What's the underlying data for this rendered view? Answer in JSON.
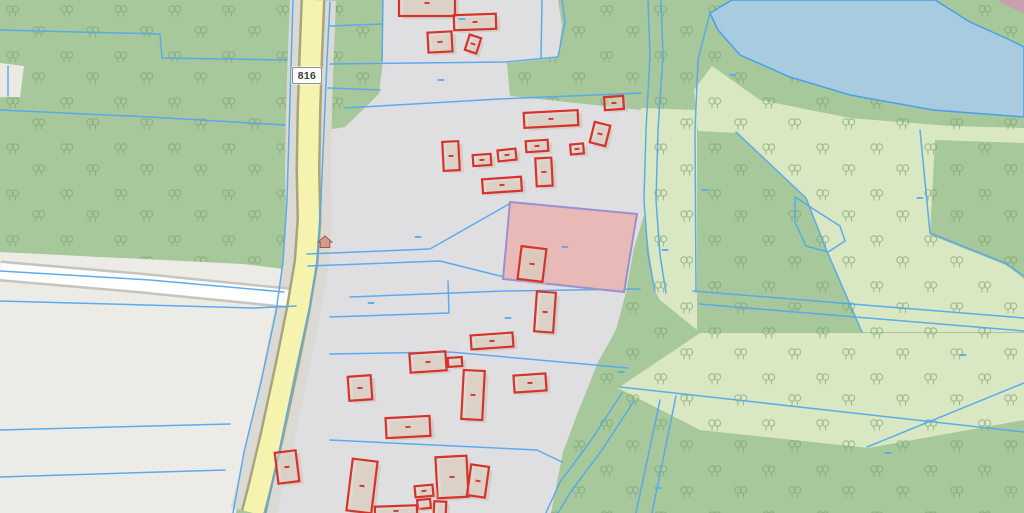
{
  "map": {
    "type": "cadastral-gis-map",
    "road_shield": {
      "label": "816"
    },
    "colors": {
      "forest": "#a7c89a",
      "pale_green": "#d9e8c3",
      "gray_parcels": "#dfdfe1",
      "beige_parcels": "#edebe5",
      "notch": "#eceae4",
      "water": "#a8cbe0",
      "water_edge": "#4aa0e8",
      "parcel_line": "#55a8ee",
      "road_fill": "#f5f3ae",
      "road_casing": "#a8a57c",
      "road_verge": "#dbd9d3",
      "white_road_fill": "#ffffff",
      "white_road_casing": "#c6c4be",
      "building_stroke": "#d5332b",
      "building_fill": "#e0d3c7",
      "building_shadow": "#cabfb2",
      "highlight_fill": "#eab5b3",
      "highlight_stroke": "#9a8fd0",
      "tree": "#7fa271",
      "corner_road": "#c79fae",
      "house_icon_fill": "#cf8a80",
      "house_icon_stroke": "#a9544b"
    },
    "regions": {
      "base": [
        [
          0,
          0
        ],
        [
          1024,
          0
        ],
        [
          1024,
          513
        ],
        [
          0,
          513
        ]
      ],
      "pale_green": [
        [
          [
            712,
            66
          ],
          [
            760,
            100
          ],
          [
            850,
            118
          ],
          [
            950,
            126
          ],
          [
            1024,
            128
          ],
          [
            1024,
            143
          ],
          [
            935,
            140
          ],
          [
            930,
            235
          ],
          [
            1008,
            266
          ],
          [
            1024,
            279
          ],
          [
            1024,
            332
          ],
          [
            862,
            332
          ],
          [
            826,
            249
          ],
          [
            806,
            198
          ],
          [
            737,
            133
          ],
          [
            698,
            131
          ],
          [
            694,
            90
          ]
        ],
        [
          [
            641,
            108
          ],
          [
            697,
            110
          ],
          [
            697,
            330
          ],
          [
            660,
            300
          ],
          [
            655,
            291
          ],
          [
            644,
            215
          ]
        ],
        [
          [
            618,
            388
          ],
          [
            700,
            333
          ],
          [
            1024,
            333
          ],
          [
            1024,
            420
          ],
          [
            868,
            448
          ],
          [
            700,
            430
          ]
        ]
      ],
      "notch": [
        [
          0,
          63
        ],
        [
          24,
          66
        ],
        [
          20,
          97
        ],
        [
          0,
          97
        ]
      ],
      "water": [
        [
          732,
          0
        ],
        [
          935,
          0
        ],
        [
          970,
          22
        ],
        [
          1010,
          40
        ],
        [
          1024,
          47
        ],
        [
          1024,
          117
        ],
        [
          933,
          110
        ],
        [
          850,
          95
        ],
        [
          790,
          77
        ],
        [
          740,
          55
        ],
        [
          718,
          30
        ],
        [
          710,
          13
        ]
      ],
      "corner_road": [
        [
          998,
          0
        ],
        [
          1024,
          0
        ],
        [
          1024,
          13
        ],
        [
          1005,
          5
        ]
      ],
      "gray_parcels": [
        [
          385,
          0
        ],
        [
          558,
          0
        ],
        [
          562,
          25
        ],
        [
          558,
          58
        ],
        [
          507,
          63
        ],
        [
          510,
          96
        ],
        [
          641,
          110
        ],
        [
          644,
          215
        ],
        [
          634,
          248
        ],
        [
          626,
          292
        ],
        [
          616,
          330
        ],
        [
          598,
          362
        ],
        [
          578,
          412
        ],
        [
          563,
          452
        ],
        [
          551,
          513
        ],
        [
          268,
          513
        ],
        [
          283,
          440
        ],
        [
          299,
          362
        ],
        [
          313,
          302
        ],
        [
          319,
          262
        ],
        [
          323,
          200
        ],
        [
          327,
          130
        ],
        [
          345,
          127
        ],
        [
          379,
          94
        ],
        [
          383,
          60
        ],
        [
          383,
          0
        ]
      ],
      "beige_parcels": [
        [
          0,
          252
        ],
        [
          243,
          264
        ],
        [
          292,
          270
        ],
        [
          286,
          308
        ],
        [
          263,
          380
        ],
        [
          246,
          450
        ],
        [
          236,
          513
        ],
        [
          0,
          513
        ]
      ]
    },
    "tree_areas": [
      [
        [
          0,
          0
        ],
        [
          340,
          0
        ],
        [
          330,
          130
        ],
        [
          324,
          200
        ],
        [
          320,
          262
        ],
        [
          240,
          264
        ],
        [
          0,
          252
        ]
      ],
      [
        [
          333,
          0
        ],
        [
          385,
          0
        ],
        [
          380,
          95
        ],
        [
          345,
          130
        ],
        [
          330,
          133
        ]
      ],
      [
        [
          558,
          0
        ],
        [
          1024,
          0
        ],
        [
          1024,
          513
        ],
        [
          548,
          513
        ],
        [
          575,
          440
        ],
        [
          600,
          360
        ],
        [
          620,
          330
        ],
        [
          628,
          292
        ],
        [
          644,
          248
        ],
        [
          646,
          215
        ],
        [
          643,
          110
        ],
        [
          510,
          96
        ],
        [
          507,
          62
        ],
        [
          560,
          57
        ],
        [
          563,
          25
        ]
      ]
    ],
    "roads": {
      "main": [
        [
          313,
          0
        ],
        [
          311,
          50
        ],
        [
          309,
          110
        ],
        [
          308,
          170
        ],
        [
          309,
          220
        ],
        [
          306,
          262
        ],
        [
          298,
          310
        ],
        [
          287,
          365
        ],
        [
          272,
          435
        ],
        [
          259,
          490
        ],
        [
          253,
          513
        ]
      ],
      "side": [
        [
          0,
          271
        ],
        [
          140,
          283
        ],
        [
          290,
          298
        ]
      ]
    },
    "parcel_lines": [
      [
        [
          0,
          30
        ],
        [
          160,
          34
        ],
        [
          162,
          58
        ],
        [
          287,
          60
        ]
      ],
      [
        [
          0,
          110
        ],
        [
          150,
          117
        ],
        [
          285,
          125
        ]
      ],
      [
        [
          0,
          271
        ],
        [
          150,
          280
        ],
        [
          284,
          292
        ]
      ],
      [
        [
          0,
          301
        ],
        [
          253,
          308
        ],
        [
          296,
          306
        ]
      ],
      [
        [
          330,
          2
        ],
        [
          327,
          60
        ],
        [
          324,
          130
        ],
        [
          321,
          200
        ],
        [
          317,
          262
        ],
        [
          310,
          305
        ],
        [
          297,
          365
        ],
        [
          281,
          442
        ],
        [
          266,
          513
        ]
      ],
      [
        [
          293,
          0
        ],
        [
          290,
          100
        ],
        [
          287,
          200
        ],
        [
          283,
          262
        ],
        [
          276,
          312
        ],
        [
          261,
          382
        ],
        [
          244,
          452
        ],
        [
          233,
          513
        ]
      ],
      [
        [
          383,
          0
        ],
        [
          382,
          61
        ]
      ],
      [
        [
          542,
          0
        ],
        [
          541,
          58
        ]
      ],
      [
        [
          330,
          64
        ],
        [
          505,
          62
        ],
        [
          558,
          57
        ],
        [
          565,
          22
        ],
        [
          562,
          0
        ]
      ],
      [
        [
          345,
          108
        ],
        [
          500,
          99
        ],
        [
          641,
          93
        ]
      ],
      [
        [
          648,
          0
        ],
        [
          650,
          55
        ],
        [
          646,
          130
        ],
        [
          644,
          200
        ],
        [
          648,
          255
        ],
        [
          655,
          291
        ]
      ],
      [
        [
          661,
          0
        ],
        [
          663,
          55
        ],
        [
          658,
          130
        ],
        [
          656,
          200
        ],
        [
          660,
          255
        ],
        [
          666,
          293
        ]
      ],
      [
        [
          307,
          254
        ],
        [
          430,
          249
        ],
        [
          509,
          204
        ]
      ],
      [
        [
          308,
          266
        ],
        [
          440,
          261
        ],
        [
          504,
          277
        ]
      ],
      [
        [
          350,
          297
        ],
        [
          504,
          291
        ],
        [
          640,
          289
        ]
      ],
      [
        [
          330,
          354
        ],
        [
          450,
          352
        ],
        [
          628,
          368
        ]
      ],
      [
        [
          448,
          281
        ],
        [
          449,
          313
        ],
        [
          330,
          317
        ]
      ],
      [
        [
          330,
          440
        ],
        [
          537,
          450
        ],
        [
          562,
          462
        ]
      ],
      [
        [
          622,
          393
        ],
        [
          590,
          442
        ],
        [
          560,
          482
        ],
        [
          546,
          513
        ]
      ],
      [
        [
          634,
          401
        ],
        [
          602,
          450
        ],
        [
          572,
          490
        ],
        [
          558,
          513
        ]
      ],
      [
        [
          0,
          430
        ],
        [
          230,
          424
        ]
      ],
      [
        [
          0,
          477
        ],
        [
          225,
          470
        ]
      ],
      [
        [
          8,
          66
        ],
        [
          8,
          96
        ]
      ],
      [
        [
          330,
          26
        ],
        [
          382,
          24
        ]
      ],
      [
        [
          328,
          88
        ],
        [
          380,
          90
        ]
      ],
      [
        [
          693,
          291
        ],
        [
          1024,
          318
        ]
      ],
      [
        [
          699,
          304
        ],
        [
          1024,
          331
        ]
      ],
      [
        [
          620,
          387
        ],
        [
          1024,
          432
        ]
      ],
      [
        [
          660,
          400
        ],
        [
          636,
          513
        ]
      ],
      [
        [
          676,
          396
        ],
        [
          652,
          513
        ]
      ],
      [
        [
          710,
          13
        ],
        [
          698,
          60
        ],
        [
          695,
          130
        ],
        [
          696,
          292
        ]
      ],
      [
        [
          795,
          197
        ],
        [
          818,
          212
        ],
        [
          840,
          226
        ],
        [
          845,
          241
        ],
        [
          828,
          252
        ],
        [
          806,
          246
        ],
        [
          795,
          222
        ],
        [
          795,
          197
        ]
      ],
      [
        [
          736,
          132
        ],
        [
          806,
          198
        ],
        [
          826,
          249
        ],
        [
          862,
          332
        ]
      ],
      [
        [
          920,
          130
        ],
        [
          930,
          233
        ],
        [
          1005,
          263
        ],
        [
          1024,
          276
        ]
      ],
      [
        [
          867,
          447
        ],
        [
          1024,
          383
        ]
      ]
    ],
    "highlight_parcel": [
      [
        510,
        202
      ],
      [
        637,
        214
      ],
      [
        624,
        292
      ],
      [
        503,
        279
      ]
    ],
    "buildings": [
      [
        427,
        3,
        56,
        26,
        0
      ],
      [
        475,
        22,
        42,
        15,
        -2
      ],
      [
        440,
        42,
        24,
        20,
        -3
      ],
      [
        473,
        44,
        12,
        16,
        18
      ],
      [
        614,
        103,
        19,
        13,
        -4
      ],
      [
        551,
        119,
        54,
        15,
        -3
      ],
      [
        600,
        134,
        16,
        21,
        14
      ],
      [
        451,
        156,
        16,
        29,
        -3
      ],
      [
        482,
        160,
        18,
        11,
        -4
      ],
      [
        507,
        155,
        18,
        11,
        -6
      ],
      [
        537,
        146,
        22,
        11,
        -4
      ],
      [
        577,
        149,
        13,
        10,
        -5
      ],
      [
        544,
        172,
        16,
        28,
        -3
      ],
      [
        502,
        185,
        39,
        14,
        -4
      ],
      [
        532,
        264,
        25,
        33,
        7
      ],
      [
        545,
        312,
        19,
        40,
        4
      ],
      [
        492,
        341,
        42,
        14,
        -4
      ],
      [
        428,
        362,
        36,
        19,
        -4
      ],
      [
        455,
        362,
        14,
        9,
        -4,
        1
      ],
      [
        473,
        395,
        21,
        49,
        3
      ],
      [
        530,
        383,
        32,
        17,
        -4
      ],
      [
        360,
        388,
        23,
        24,
        -4
      ],
      [
        408,
        427,
        44,
        20,
        -3
      ],
      [
        362,
        486,
        25,
        52,
        7
      ],
      [
        452,
        477,
        31,
        41,
        -3
      ],
      [
        478,
        481,
        18,
        31,
        8
      ],
      [
        424,
        491,
        18,
        11,
        -5
      ],
      [
        424,
        504,
        13,
        9,
        -5,
        1
      ],
      [
        440,
        508,
        12,
        13,
        3,
        1
      ],
      [
        396,
        511,
        42,
        10,
        -2
      ],
      [
        287,
        467,
        21,
        31,
        -7
      ]
    ],
    "label_dashes": [
      [
        462,
        19
      ],
      [
        441,
        80
      ],
      [
        418,
        237
      ],
      [
        565,
        247
      ],
      [
        371,
        303
      ],
      [
        508,
        318
      ],
      [
        705,
        190
      ],
      [
        665,
        250
      ],
      [
        920,
        198
      ],
      [
        963,
        355
      ],
      [
        888,
        453
      ],
      [
        621,
        372
      ],
      [
        658,
        488
      ],
      [
        733,
        75
      ]
    ],
    "house_icon": {
      "x": 318,
      "y": 236
    }
  }
}
